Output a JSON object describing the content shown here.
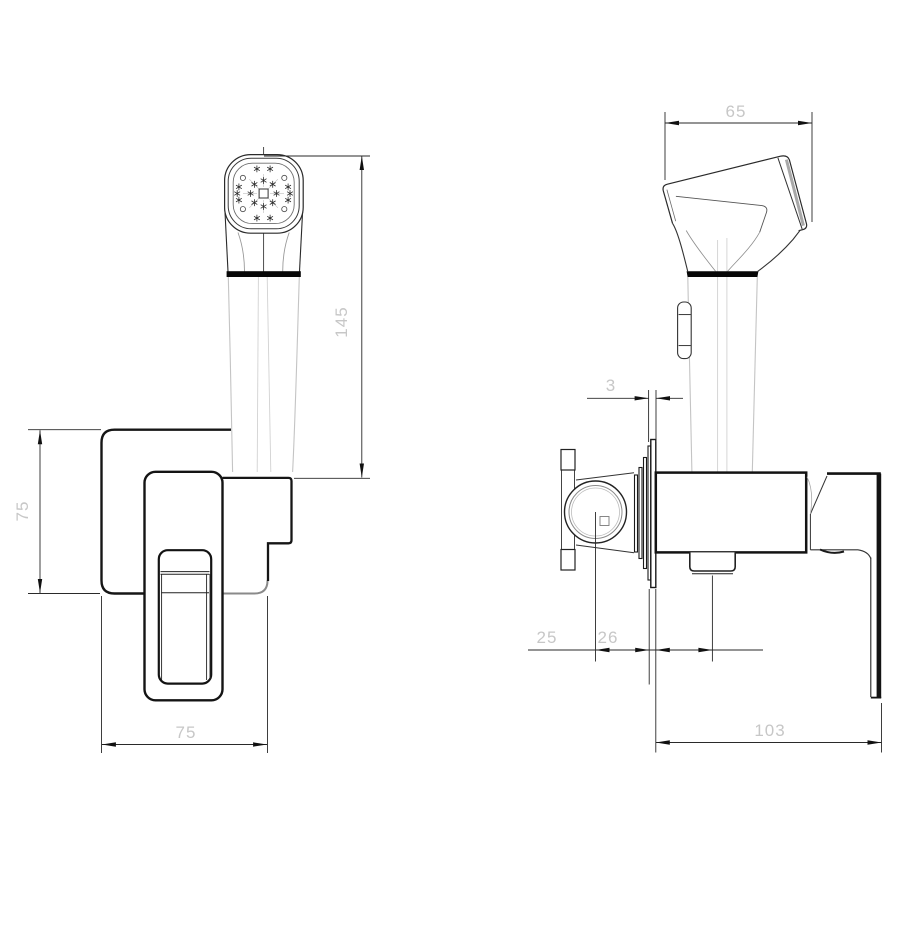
{
  "drawing": {
    "type": "technical-orthographic-drawing",
    "subject": "wall-mounted hygienic shower / bidet spray set with concealed mixer",
    "background_color": "#ffffff",
    "outline_color": "#1a1a1a",
    "profile_line_color": "#c4c4c4",
    "dim_text_color": "#c7c7c7",
    "views": {
      "front": {
        "label": "front-view",
        "dims": {
          "overall_height": "145",
          "plate_height": "75",
          "plate_width": "75"
        }
      },
      "side": {
        "label": "side-view",
        "dims": {
          "head_width": "65",
          "plate_thickness": "3",
          "inlet_to_plate": "25",
          "plate_to_outlet": "26",
          "body_depth": "103"
        }
      }
    }
  }
}
